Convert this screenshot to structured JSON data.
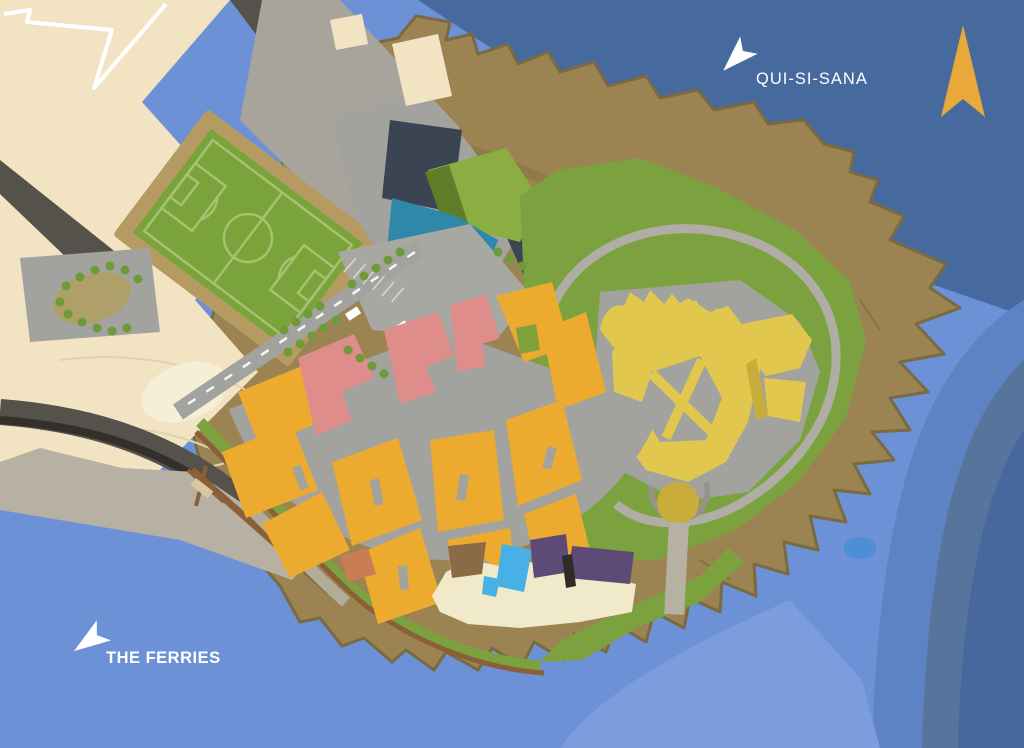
{
  "map": {
    "labels": {
      "qui_si_sana": "QUI-SI-SANA",
      "the_ferries": "THE FERRIES"
    },
    "icons": {
      "north_arrow": "north-compass-arrow",
      "direction_arrow": "navigation-arrow",
      "tree": "tree-dot"
    }
  },
  "colors": {
    "water_mid": "#6C91D6",
    "water_ne": "#46699E",
    "band_a": "#5E83C4",
    "band_b": "#56749C",
    "band_c": "#46689D",
    "water_light": "#7D9CDE",
    "water_pale": "#A9C2EC",
    "pond": "#4C8FD6",
    "cream": "#F2E4C2",
    "cream_light": "#F7EED8",
    "contour": "#E2D3AC",
    "road_dark": "#55514B",
    "road_core": "#33302B",
    "slab": "#A8A39B",
    "quay": "#B6B1A2",
    "street": "#A2A29E",
    "plaza": "#A8A8A2",
    "promenade": "#B3AC99",
    "track_tan": "#B59A62",
    "garden_tan": "#AFA06A",
    "pitch_green": "#7AA33C",
    "pitch_line": "#A5C270",
    "lawn": "#7CA23F",
    "lawn_bright": "#8CAD42",
    "lawn_dark": "#5F7E2B",
    "tree": "#6E9A38",
    "courtyard": "#7FA03A",
    "rock": "#9C8452",
    "rock_edge": "#7A6A42",
    "rock_streak": "#877243",
    "orange": "#ECAB2F",
    "pink": "#DE8D8B",
    "teal": "#2F88A9",
    "navy": "#3B4452",
    "fort_yellow": "#E2C74E",
    "fort_shadow": "#C9AD3B",
    "purple": "#5E4A76",
    "pool": "#47B0E6",
    "deck": "#F0EACB",
    "brown_patch": "#8B6B45",
    "boardwalk": "#8A6038",
    "terracotta": "#C97D55",
    "pier_cream": "#D8C8A2",
    "white": "#FFFFFF",
    "north_gold": "#E8A93A",
    "dark_bit": "#2F2C28",
    "ring_gray": "#97938B",
    "path_gray": "#B0ACA6"
  }
}
